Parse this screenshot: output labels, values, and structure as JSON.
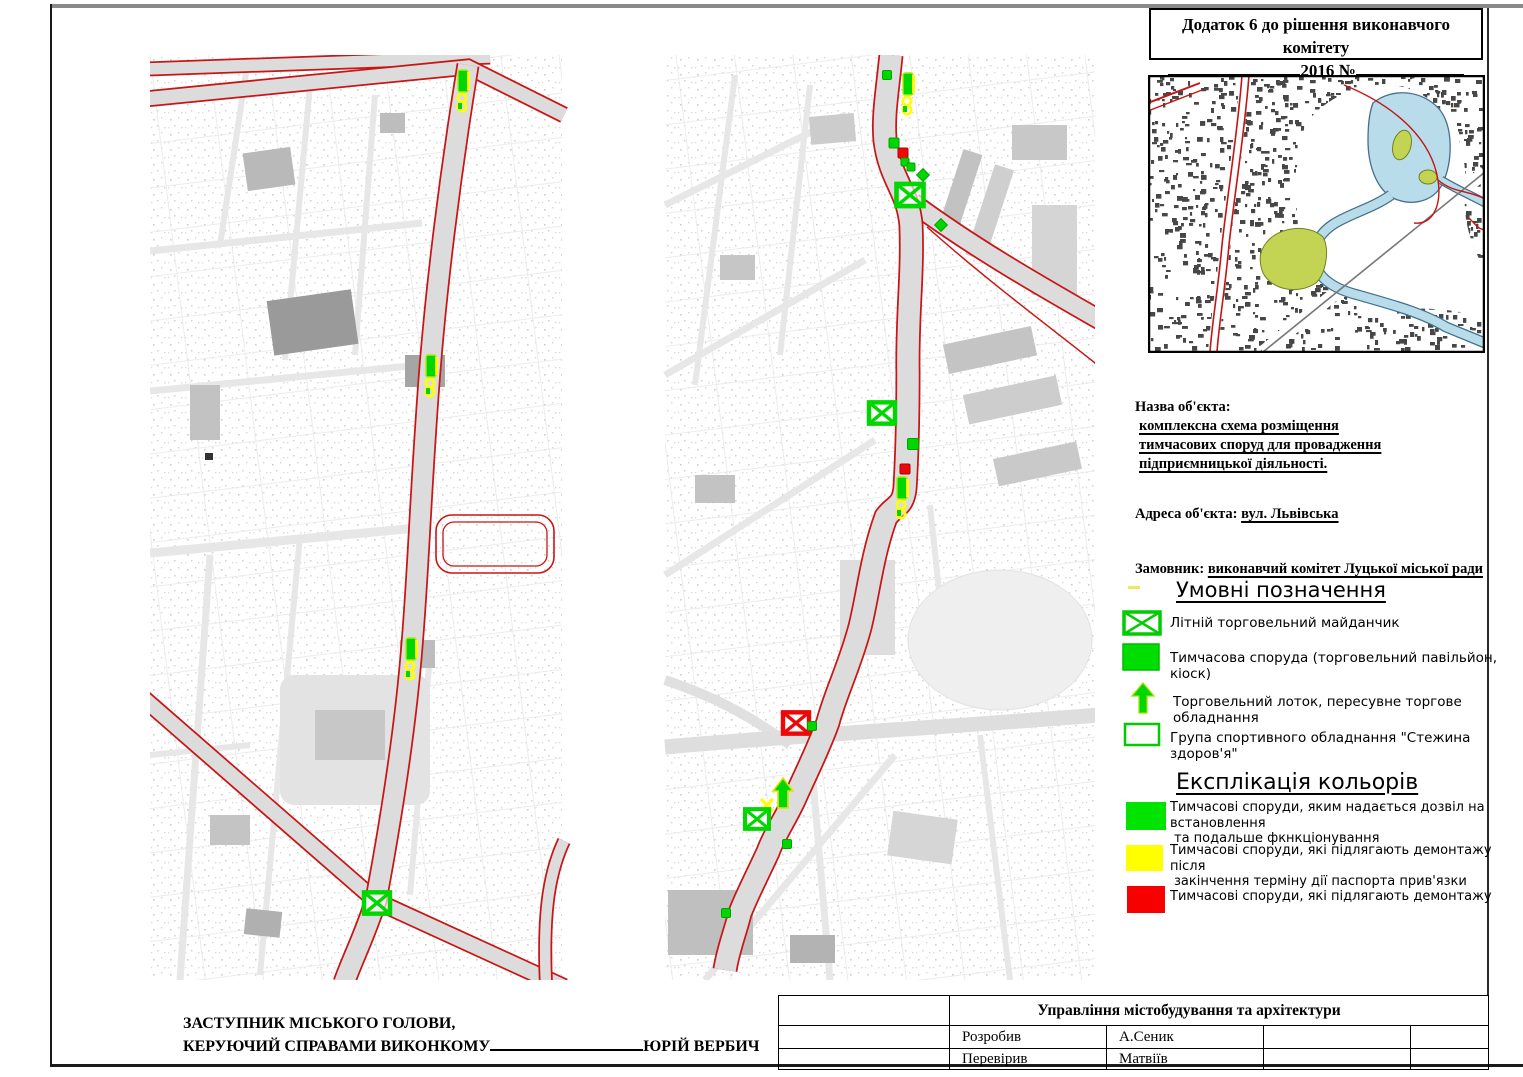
{
  "header": {
    "line1": "Додаток 6 до рішення виконавчого комітету",
    "year": "2016",
    "number_sign": "№"
  },
  "object_info": {
    "name_label": "Назва об'єкта:",
    "name_lines": [
      "комплексна схема розміщення",
      "тимчасових споруд для провадження",
      "підприємницької діяльності."
    ],
    "address_label": "Адреса об'єкта:",
    "address_value": "вул. Львівська",
    "customer_label": "Замовник:",
    "customer_value": "виконавчий комітет Луцької міської ради"
  },
  "legend": {
    "title": "Умовні позначення",
    "items": [
      {
        "icon": "summer-trade-platform-icon",
        "label": "Літній торговельний майданчик"
      },
      {
        "icon": "temporary-structure-icon",
        "label": "Тимчасова споруда (торговельний павільйон, кіоск)"
      },
      {
        "icon": "trade-tray-arrow-icon",
        "label": "Торговельний лоток, пересувне торгове обладнання"
      },
      {
        "icon": "sports-equipment-icon",
        "label": "Група спортивного обладнання  \"Стежина здоров'я\""
      }
    ]
  },
  "colors_legend": {
    "title": "Експлікація кольорів",
    "items": [
      {
        "color": "#00e400",
        "lines": [
          "Тимчасові споруди, яким надається дозвіл на встановлення",
          "та подальше фкнкціонування"
        ]
      },
      {
        "color": "#ffff00",
        "lines": [
          "Тимчасові споруди, які підлягають демонтажу після",
          "закінчення терміну дії паспорта прив'язки"
        ]
      },
      {
        "color": "#f60000",
        "lines": [
          "Тимчасові споруди, які підлягають демонтажу"
        ]
      }
    ]
  },
  "signature": {
    "line1": "ЗАСТУПНИК МІСЬКОГО ГОЛОВИ,",
    "line2": "КЕРУЮЧИЙ СПРАВАМИ ВИКОНКОМУ",
    "name": "ЮРІЙ ВЕРБИЧ"
  },
  "title_block": {
    "department": "Управління містобудування та архітектури",
    "rows": [
      {
        "role": "Розробив",
        "name": "А.Сеник"
      },
      {
        "role": "Перевірив",
        "name": "Матвіїв"
      }
    ]
  },
  "palette": {
    "marker_green": "#00d600",
    "marker_green_stroke": "#00a300",
    "marker_red": "#ee0707",
    "marker_yellow": "#ffff00",
    "route_red": "#c81616",
    "water_blue": "#b9dcea",
    "olive_green": "#c3d455",
    "overview_buildings": "#474747"
  },
  "maps": {
    "left_markers": [
      {
        "t": "stack",
        "x": 313,
        "y": 15
      },
      {
        "t": "stack",
        "x": 281,
        "y": 300
      },
      {
        "t": "stack",
        "x": 261,
        "y": 583
      },
      {
        "t": "xbox",
        "x": 227,
        "y": 848,
        "c": "green",
        "s": 26
      }
    ],
    "center_markers": [
      {
        "t": "sq",
        "x": 222,
        "y": 20,
        "c": "green",
        "s": 9
      },
      {
        "t": "stack",
        "x": 243,
        "y": 18
      },
      {
        "t": "sq",
        "x": 229,
        "y": 88,
        "c": "green",
        "s": 10
      },
      {
        "t": "sq",
        "x": 238,
        "y": 98,
        "c": "red",
        "s": 10
      },
      {
        "t": "sq",
        "x": 240,
        "y": 107,
        "c": "green",
        "s": 8
      },
      {
        "t": "sq",
        "x": 246,
        "y": 112,
        "c": "green",
        "s": 8
      },
      {
        "t": "diamond",
        "x": 258,
        "y": 120,
        "c": "green",
        "s": 9
      },
      {
        "t": "xbox",
        "x": 245,
        "y": 140,
        "c": "green",
        "s": 27
      },
      {
        "t": "diamond",
        "x": 276,
        "y": 170,
        "c": "green",
        "s": 9
      },
      {
        "t": "xbox",
        "x": 217,
        "y": 358,
        "c": "green",
        "s": 26
      },
      {
        "t": "sq",
        "x": 248,
        "y": 389,
        "c": "green",
        "s": 11
      },
      {
        "t": "sq",
        "x": 240,
        "y": 414,
        "c": "red",
        "s": 10
      },
      {
        "t": "stack",
        "x": 237,
        "y": 422
      },
      {
        "t": "xbox",
        "x": 131,
        "y": 668,
        "c": "red",
        "s": 26
      },
      {
        "t": "sq",
        "x": 147,
        "y": 671,
        "c": "green",
        "s": 9
      },
      {
        "t": "arrow",
        "x": 118,
        "y": 723
      },
      {
        "t": "yx",
        "x": 102,
        "y": 750
      },
      {
        "t": "xbox",
        "x": 92,
        "y": 764,
        "c": "green",
        "s": 24
      },
      {
        "t": "sq",
        "x": 122,
        "y": 789,
        "c": "green",
        "s": 9
      },
      {
        "t": "sq",
        "x": 61,
        "y": 858,
        "c": "green",
        "s": 9
      }
    ]
  }
}
